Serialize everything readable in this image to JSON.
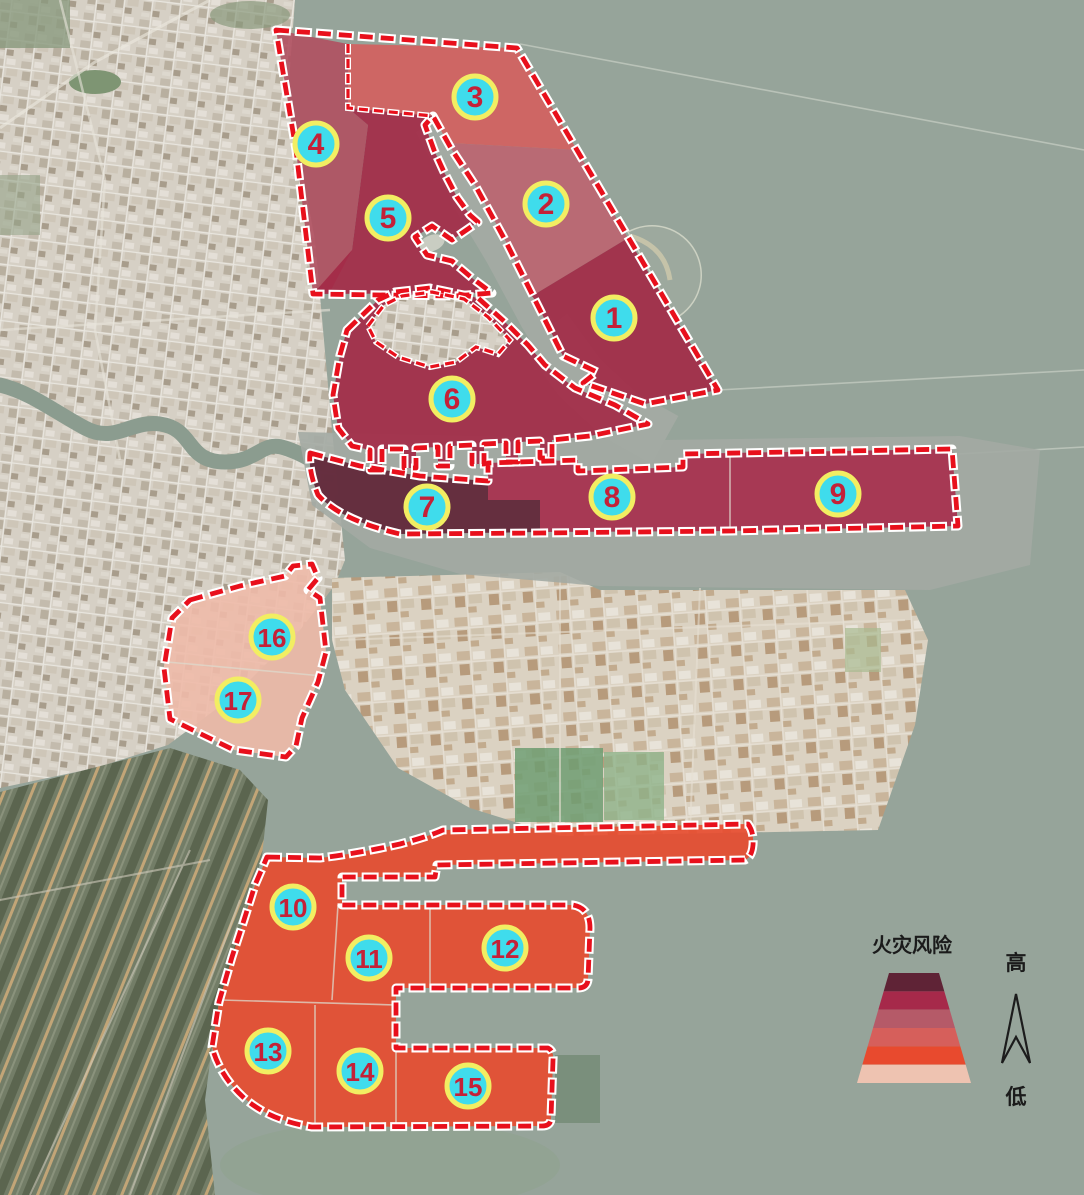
{
  "legend": {
    "title": "火灾风险",
    "high_label": "高",
    "low_label": "低",
    "levels": [
      {
        "rank": 1,
        "color": "#5f2336"
      },
      {
        "rank": 2,
        "color": "#a6294a"
      },
      {
        "rank": 3,
        "color": "#b55a68"
      },
      {
        "rank": 4,
        "color": "#d65f5b"
      },
      {
        "rank": 5,
        "color": "#e84a2e"
      },
      {
        "rank": 6,
        "color": "#eec3b1"
      }
    ]
  },
  "badge_style": {
    "fill_color": "#3fdcec",
    "ring_color": "#f2ee62",
    "number_color": "#c42138"
  },
  "outline": {
    "color": "#e8101c",
    "casing_color": "#ffffff"
  },
  "zones": [
    {
      "label": "1",
      "color": "#a22845",
      "level": 2,
      "badge": {
        "x": 614,
        "y": 318
      }
    },
    {
      "label": "2",
      "color": "#bd6470",
      "level": 3,
      "badge": {
        "x": 546,
        "y": 204
      }
    },
    {
      "label": "3",
      "color": "#d45f5e",
      "level": 4,
      "badge": {
        "x": 475,
        "y": 97
      }
    },
    {
      "label": "4",
      "color": "#b05060",
      "level": 3,
      "badge": {
        "x": 316,
        "y": 144
      }
    },
    {
      "label": "5",
      "color": "#a32946",
      "level": 2,
      "badge": {
        "x": 388,
        "y": 218
      }
    },
    {
      "label": "6",
      "color": "#a32946",
      "level": 2,
      "badge": {
        "x": 452,
        "y": 399
      }
    },
    {
      "label": "7",
      "color": "#5e2134",
      "level": 1,
      "badge": {
        "x": 427,
        "y": 507
      }
    },
    {
      "label": "8",
      "color": "#a72c4b",
      "level": 2,
      "badge": {
        "x": 612,
        "y": 497
      }
    },
    {
      "label": "9",
      "color": "#a72c4b",
      "level": 2,
      "badge": {
        "x": 838,
        "y": 494
      }
    },
    {
      "label": "10",
      "color": "#e84a2e",
      "level": 5,
      "badge": {
        "x": 293,
        "y": 907
      }
    },
    {
      "label": "11",
      "color": "#e84a2e",
      "level": 5,
      "badge": {
        "x": 369,
        "y": 958
      }
    },
    {
      "label": "12",
      "color": "#e84a2e",
      "level": 5,
      "badge": {
        "x": 505,
        "y": 948
      }
    },
    {
      "label": "13",
      "color": "#e84a2e",
      "level": 5,
      "badge": {
        "x": 268,
        "y": 1051
      }
    },
    {
      "label": "14",
      "color": "#e84a2e",
      "level": 5,
      "badge": {
        "x": 360,
        "y": 1071
      }
    },
    {
      "label": "15",
      "color": "#e84a2e",
      "level": 5,
      "badge": {
        "x": 468,
        "y": 1086
      }
    },
    {
      "label": "16",
      "color": "#eebaa9",
      "level": 6,
      "badge": {
        "x": 272,
        "y": 637
      }
    },
    {
      "label": "17",
      "color": "#ecb3a1",
      "level": 6,
      "badge": {
        "x": 238,
        "y": 700
      }
    }
  ]
}
